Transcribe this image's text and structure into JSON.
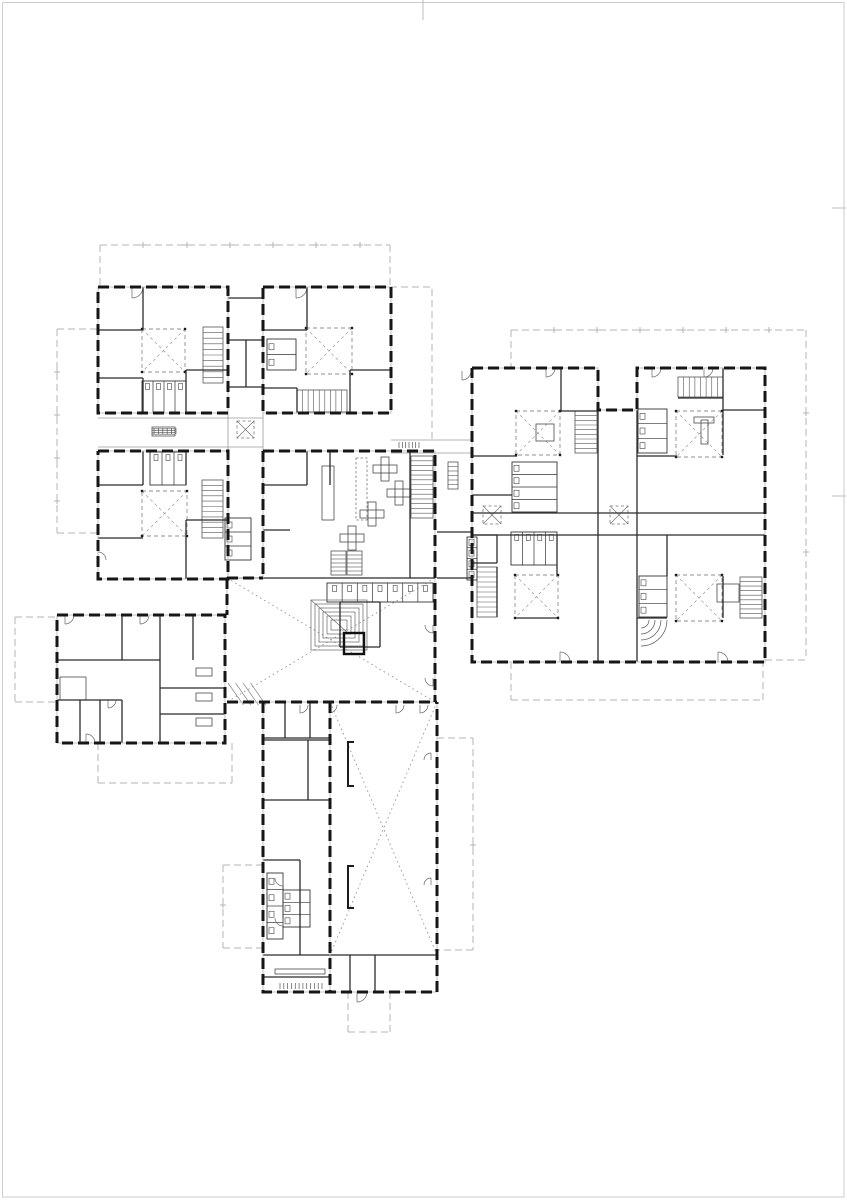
{
  "canvas": {
    "w": 847,
    "h": 1200
  },
  "palette": {
    "paper": "#ffffff",
    "page_border": "#cdcdcd",
    "page_tick": "#bdbdbd",
    "wall_black": "#161616",
    "wall_under": "#c2c2c2",
    "partition": "#2b2b2b",
    "thin": "#9a9a9a",
    "roof_dash": "#b4b4b4",
    "dotted": "#8c8c8c",
    "detail": "#4a4a4a",
    "void_dash": "#8f8f8f"
  },
  "page": {
    "border_rect": [
      2.5,
      2.5,
      841.5,
      1194.5
    ],
    "top_ticks": [
      [
        423,
        0,
        423,
        20
      ]
    ],
    "right_ticks": [
      [
        832,
        208,
        846,
        208
      ],
      [
        832,
        496,
        846,
        496
      ]
    ]
  },
  "plan": {
    "roof_dashed": [
      [
        [
          100,
          245
        ],
        [
          390,
          245
        ]
      ],
      [
        [
          100,
          245
        ],
        [
          100,
          287
        ]
      ],
      [
        [
          390,
          245
        ],
        [
          390,
          287
        ]
      ],
      [
        [
          390,
          287
        ],
        [
          432,
          287
        ],
        [
          432,
          440
        ]
      ],
      [
        [
          57,
          329
        ],
        [
          98,
          329
        ]
      ],
      [
        [
          57,
          329
        ],
        [
          57,
          533
        ]
      ],
      [
        [
          57,
          533
        ],
        [
          98,
          533
        ]
      ],
      [
        [
          15,
          617
        ],
        [
          57,
          617
        ]
      ],
      [
        [
          15,
          617
        ],
        [
          15,
          702
        ]
      ],
      [
        [
          15,
          702
        ],
        [
          57,
          702
        ]
      ],
      [
        [
          98,
          743
        ],
        [
          98,
          783
        ]
      ],
      [
        [
          98,
          783
        ],
        [
          232,
          783
        ]
      ],
      [
        [
          232,
          783
        ],
        [
          232,
          743
        ]
      ],
      [
        [
          223,
          865
        ],
        [
          262,
          865
        ]
      ],
      [
        [
          223,
          865
        ],
        [
          223,
          948
        ]
      ],
      [
        [
          223,
          948
        ],
        [
          262,
          948
        ]
      ],
      [
        [
          437,
          738
        ],
        [
          473,
          738
        ]
      ],
      [
        [
          473,
          738
        ],
        [
          473,
          950
        ]
      ],
      [
        [
          473,
          950
        ],
        [
          437,
          950
        ]
      ],
      [
        [
          348,
          992
        ],
        [
          348,
          1032
        ]
      ],
      [
        [
          348,
          1032
        ],
        [
          390,
          1032
        ]
      ],
      [
        [
          390,
          1032
        ],
        [
          390,
          992
        ]
      ],
      [
        [
          511,
          330
        ],
        [
          806,
          330
        ]
      ],
      [
        [
          511,
          330
        ],
        [
          511,
          368
        ]
      ],
      [
        [
          806,
          330
        ],
        [
          806,
          660
        ]
      ],
      [
        [
          765,
          660
        ],
        [
          806,
          660
        ]
      ],
      [
        [
          511,
          662
        ],
        [
          511,
          700
        ]
      ],
      [
        [
          511,
          700
        ],
        [
          763,
          700
        ]
      ],
      [
        [
          763,
          700
        ],
        [
          763,
          662
        ]
      ]
    ],
    "grid_ticks": [
      [
        143,
        245
      ],
      [
        187,
        245
      ],
      [
        230,
        245
      ],
      [
        273,
        245
      ],
      [
        316,
        245
      ],
      [
        360,
        245
      ],
      [
        57,
        372
      ],
      [
        57,
        415
      ],
      [
        57,
        458
      ],
      [
        57,
        501
      ],
      [
        554,
        330
      ],
      [
        597,
        330
      ],
      [
        640,
        330
      ],
      [
        683,
        330
      ],
      [
        726,
        330
      ],
      [
        769,
        330
      ],
      [
        806,
        413
      ],
      [
        806,
        552
      ],
      [
        223,
        905
      ],
      [
        473,
        845
      ]
    ],
    "walls_ext": [
      [
        [
          98,
          287
        ],
        [
          228,
          287
        ],
        [
          228,
          413
        ],
        [
          98,
          413
        ],
        [
          98,
          287
        ]
      ],
      [
        [
          263,
          287
        ],
        [
          391,
          287
        ],
        [
          391,
          413
        ],
        [
          263,
          413
        ],
        [
          263,
          287
        ]
      ],
      [
        [
          98,
          451
        ],
        [
          228,
          451
        ],
        [
          228,
          579
        ],
        [
          98,
          579
        ],
        [
          98,
          451
        ]
      ],
      [
        [
          263,
          451
        ],
        [
          435,
          451
        ],
        [
          435,
          702
        ]
      ],
      [
        [
          263,
          451
        ],
        [
          263,
          578
        ]
      ],
      [
        [
          227,
          578
        ],
        [
          263,
          578
        ]
      ],
      [
        [
          227,
          578
        ],
        [
          227,
          615
        ]
      ],
      [
        [
          227,
          702
        ],
        [
          437,
          702
        ]
      ],
      [
        [
          57,
          615
        ],
        [
          225,
          615
        ],
        [
          225,
          743
        ],
        [
          57,
          743
        ],
        [
          57,
          615
        ]
      ],
      [
        [
          263,
          702
        ],
        [
          263,
          992
        ],
        [
          437,
          992
        ],
        [
          437,
          702
        ]
      ],
      [
        [
          330,
          702
        ],
        [
          330,
          992
        ]
      ],
      [
        [
          472,
          368
        ],
        [
          598,
          368
        ],
        [
          598,
          410
        ],
        [
          637,
          410
        ],
        [
          637,
          368
        ],
        [
          765,
          368
        ],
        [
          765,
          662
        ],
        [
          472,
          662
        ],
        [
          472,
          368
        ]
      ]
    ],
    "partitions": [
      [
        98,
        330,
        143,
        330
      ],
      [
        143,
        287,
        143,
        330
      ],
      [
        98,
        378,
        143,
        378
      ],
      [
        143,
        378,
        143,
        413
      ],
      [
        186,
        370,
        228,
        370
      ],
      [
        186,
        370,
        186,
        413
      ],
      [
        263,
        330,
        307,
        330
      ],
      [
        307,
        287,
        307,
        330
      ],
      [
        263,
        388,
        297,
        388
      ],
      [
        297,
        388,
        297,
        413
      ],
      [
        350,
        370,
        391,
        370
      ],
      [
        350,
        370,
        350,
        413
      ],
      [
        228,
        298,
        263,
        298
      ],
      [
        228,
        340,
        263,
        340
      ],
      [
        228,
        387,
        263,
        387
      ],
      [
        246,
        340,
        246,
        387
      ],
      [
        98,
        485,
        143,
        485
      ],
      [
        143,
        451,
        143,
        485
      ],
      [
        186,
        451,
        186,
        485
      ],
      [
        98,
        538,
        143,
        538
      ],
      [
        186,
        520,
        228,
        520
      ],
      [
        186,
        520,
        186,
        579
      ],
      [
        263,
        485,
        307,
        485
      ],
      [
        307,
        451,
        307,
        485
      ],
      [
        330,
        451,
        330,
        485
      ],
      [
        263,
        530,
        290,
        530
      ],
      [
        410,
        451,
        410,
        578
      ],
      [
        227,
        578,
        435,
        578
      ],
      [
        340,
        602,
        380,
        602
      ],
      [
        380,
        602,
        380,
        647
      ],
      [
        340,
        602,
        340,
        647
      ],
      [
        340,
        647,
        380,
        647
      ],
      [
        285,
        702,
        285,
        738
      ],
      [
        310,
        702,
        310,
        738
      ],
      [
        263,
        738,
        330,
        738
      ],
      [
        57,
        660,
        160,
        660
      ],
      [
        160,
        615,
        160,
        743
      ],
      [
        122,
        615,
        122,
        660
      ],
      [
        80,
        700,
        80,
        743
      ],
      [
        100,
        700,
        100,
        743
      ],
      [
        122,
        700,
        122,
        743
      ],
      [
        57,
        700,
        122,
        700
      ],
      [
        160,
        688,
        225,
        688
      ],
      [
        160,
        714,
        225,
        714
      ],
      [
        193,
        615,
        193,
        660
      ],
      [
        263,
        740,
        330,
        740
      ],
      [
        263,
        800,
        330,
        800
      ],
      [
        308,
        740,
        308,
        800
      ],
      [
        300,
        860,
        300,
        955
      ],
      [
        263,
        860,
        300,
        860
      ],
      [
        263,
        955,
        437,
        955
      ],
      [
        263,
        977,
        330,
        977
      ],
      [
        350,
        955,
        350,
        992
      ],
      [
        375,
        955,
        375,
        992
      ],
      [
        598,
        410,
        598,
        662
      ],
      [
        637,
        410,
        637,
        662
      ],
      [
        472,
        513,
        765,
        513
      ],
      [
        472,
        535,
        765,
        535
      ],
      [
        472,
        456,
        517,
        456
      ],
      [
        561,
        368,
        561,
        411
      ],
      [
        561,
        411,
        597,
        411
      ],
      [
        472,
        495,
        512,
        495
      ],
      [
        637,
        456,
        677,
        456
      ],
      [
        723,
        368,
        723,
        455
      ],
      [
        678,
        398,
        723,
        398
      ],
      [
        723,
        410,
        765,
        410
      ],
      [
        557,
        535,
        557,
        576
      ],
      [
        516,
        618,
        557,
        618
      ],
      [
        497,
        567,
        497,
        617
      ],
      [
        667,
        535,
        667,
        576
      ],
      [
        723,
        576,
        723,
        618
      ],
      [
        637,
        618,
        667,
        618
      ],
      [
        437,
        532,
        472,
        532
      ],
      [
        437,
        578,
        472,
        578
      ],
      [
        472,
        535,
        497,
        535
      ],
      [
        497,
        535,
        497,
        563
      ],
      [
        472,
        563,
        497,
        563
      ]
    ],
    "thin_lines": [
      [
        98,
        418,
        263,
        418
      ],
      [
        98,
        447,
        263,
        447
      ],
      [
        391,
        440,
        472,
        440
      ],
      [
        391,
        453,
        472,
        453
      ],
      [
        228,
        413,
        228,
        451
      ],
      [
        263,
        413,
        263,
        451
      ]
    ],
    "dotted_cross_rects": [
      [
        227,
        578,
        208,
        124
      ],
      [
        330,
        702,
        107,
        253
      ]
    ],
    "voids": [
      [
        142,
        329,
        43
      ],
      [
        306,
        328,
        46
      ],
      [
        142,
        491,
        45
      ],
      [
        516,
        411,
        44
      ],
      [
        676,
        411,
        46
      ],
      [
        515,
        575,
        43
      ],
      [
        676,
        575,
        46
      ]
    ],
    "skylights": [
      [
        237,
        421,
        17
      ],
      [
        483,
        506,
        18
      ],
      [
        610,
        506,
        18
      ]
    ],
    "stairs": [
      [
        203,
        327,
        20,
        56,
        10,
        "h"
      ],
      [
        297,
        390,
        50,
        22,
        9,
        "v"
      ],
      [
        202,
        480,
        21,
        58,
        11,
        "h"
      ],
      [
        411,
        456,
        22,
        62,
        13,
        "h"
      ],
      [
        575,
        411,
        22,
        42,
        9,
        "h"
      ],
      [
        678,
        377,
        45,
        20,
        8,
        "v"
      ],
      [
        477,
        567,
        20,
        50,
        10,
        "h"
      ],
      [
        740,
        577,
        22,
        41,
        9,
        "h"
      ],
      [
        331,
        551,
        15,
        24,
        6,
        "h"
      ],
      [
        347,
        551,
        15,
        24,
        6,
        "h"
      ]
    ],
    "toilets": [
      [
        142,
        381,
        44,
        32,
        4
      ],
      [
        267,
        339,
        29,
        31,
        2
      ],
      [
        150,
        452,
        36,
        33,
        3
      ],
      [
        225,
        518,
        26,
        42,
        3
      ],
      [
        327,
        583,
        106,
        19,
        7
      ],
      [
        512,
        462,
        45,
        50,
        4
      ],
      [
        638,
        409,
        29,
        44,
        3
      ],
      [
        511,
        532,
        46,
        33,
        4
      ],
      [
        639,
        576,
        28,
        41,
        3
      ],
      [
        467,
        537,
        10,
        43,
        4
      ],
      [
        267,
        873,
        16,
        66,
        4
      ],
      [
        283,
        890,
        27,
        37,
        3
      ]
    ],
    "furniture_rects": [
      [
        322,
        466,
        12,
        54
      ],
      [
        60,
        677,
        26,
        23
      ],
      [
        196,
        668,
        16,
        8
      ],
      [
        196,
        693,
        16,
        8
      ],
      [
        196,
        718,
        16,
        8
      ],
      [
        536,
        424,
        18,
        17
      ],
      [
        717,
        584,
        22,
        18
      ],
      [
        275,
        969,
        50,
        5
      ],
      [
        701,
        420,
        7,
        24
      ],
      [
        694,
        417,
        20,
        6
      ]
    ],
    "furniture_dashed_rects": [
      [
        356,
        458,
        11,
        62
      ]
    ],
    "plus_tables": [
      [
        385,
        469,
        24
      ],
      [
        399,
        493,
        24
      ],
      [
        372,
        514,
        24
      ],
      [
        352,
        538,
        24
      ]
    ],
    "tick_rows": [
      [
        280,
        983,
        42,
        12
      ],
      [
        399,
        442,
        20,
        7
      ],
      [
        154,
        428,
        22,
        6
      ]
    ],
    "grids": [
      [
        448,
        462,
        10,
        27,
        6
      ],
      [
        152,
        427,
        23,
        9,
        5
      ]
    ],
    "brackets": [
      [
        348,
        742,
        44
      ],
      [
        348,
        866,
        42
      ]
    ],
    "hatches": [
      [
        228,
        683,
        30,
        22,
        4
      ]
    ],
    "amphitheater": {
      "x": 311,
      "y": 600,
      "w": 56,
      "h": 50,
      "steps": 6,
      "inset": 4
    },
    "arc_fans": [
      {
        "cx": 641,
        "cy": 620,
        "radii": [
          8,
          14,
          20,
          26
        ],
        "quad": "se"
      }
    ],
    "elevator": [
      344,
      633,
      20,
      21
    ],
    "doors": [
      [
        132,
        287,
        11,
        "se"
      ],
      [
        296,
        287,
        11,
        "se"
      ],
      [
        462,
        371,
        9,
        "se"
      ],
      [
        546,
        368,
        9,
        "se"
      ],
      [
        652,
        368,
        9,
        "se"
      ],
      [
        704,
        368,
        9,
        "se"
      ],
      [
        560,
        662,
        10,
        "ne"
      ],
      [
        718,
        662,
        10,
        "ne"
      ],
      [
        300,
        705,
        8,
        "se"
      ],
      [
        329,
        705,
        8,
        "se"
      ],
      [
        396,
        705,
        8,
        "se"
      ],
      [
        420,
        705,
        8,
        "se"
      ],
      [
        283,
        878,
        8,
        "sw"
      ],
      [
        283,
        918,
        8,
        "sw"
      ],
      [
        65,
        615,
        9,
        "se"
      ],
      [
        140,
        615,
        9,
        "se"
      ],
      [
        86,
        743,
        9,
        "ne"
      ],
      [
        108,
        700,
        8,
        "se"
      ],
      [
        433,
        625,
        8,
        "sw"
      ],
      [
        433,
        678,
        8,
        "sw"
      ],
      [
        357,
        992,
        10,
        "se"
      ],
      [
        431,
        760,
        7,
        "nw"
      ],
      [
        431,
        885,
        7,
        "nw"
      ],
      [
        98,
        560,
        8,
        "ne"
      ]
    ]
  }
}
